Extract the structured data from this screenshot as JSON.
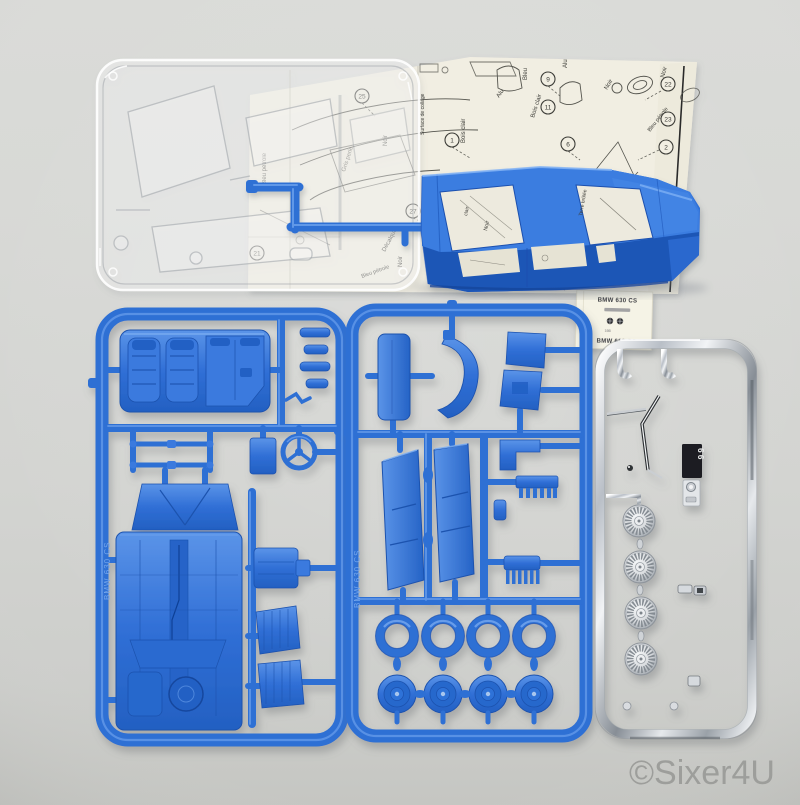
{
  "watermark": "©Sixer4U",
  "sheet": {
    "labels": {
      "bleu": "Bleu",
      "alu_a": "Alu",
      "alu_b": "Alu",
      "bois_clair_a": "Bois clair",
      "bois_clair_b": "Bois clair",
      "noir_a": "Noir",
      "noir_b": "Noir",
      "noir_c": "Noir",
      "noir_d": "Noir",
      "bleu_petrole_a": "Bleu pétrole",
      "bleu_petrole_b": "Bleu pétrole",
      "bleu_petrole_c": "Bleu pétrole",
      "gris_perle": "Gris perle",
      "surface_de_collage": "Surface de collage",
      "decalque": "Décalque",
      "gris": "Gris",
      "terre_brulee": "Terre brûlée",
      "noir_window": "Noir",
      "clair": "clair"
    },
    "callouts": {
      "c1": "1",
      "c2": "2",
      "c6": "6",
      "c9": "9",
      "c11": "11",
      "c12": "12",
      "c18": "18",
      "c21": "21",
      "c22": "22",
      "c23": "23",
      "c25": "25",
      "c27": "27"
    }
  },
  "decal": {
    "top": "BMW 630 CS",
    "number": "166",
    "bottom": "BMW 630 CS"
  },
  "sprue_marks": {
    "left": "BMW 630 CS",
    "middle": "BMW 630 CS",
    "plate": "66"
  },
  "colors": {
    "background": "#d6d7d4",
    "blue_plastic": "#2e6fd4",
    "blue_dark": "#1d55b4",
    "blue_light": "#5e97e8",
    "paper": "#f1eee2",
    "chrome": "#c9cdd2",
    "ink": "#3d3d38",
    "watermark_gray": "#9b9c99"
  }
}
